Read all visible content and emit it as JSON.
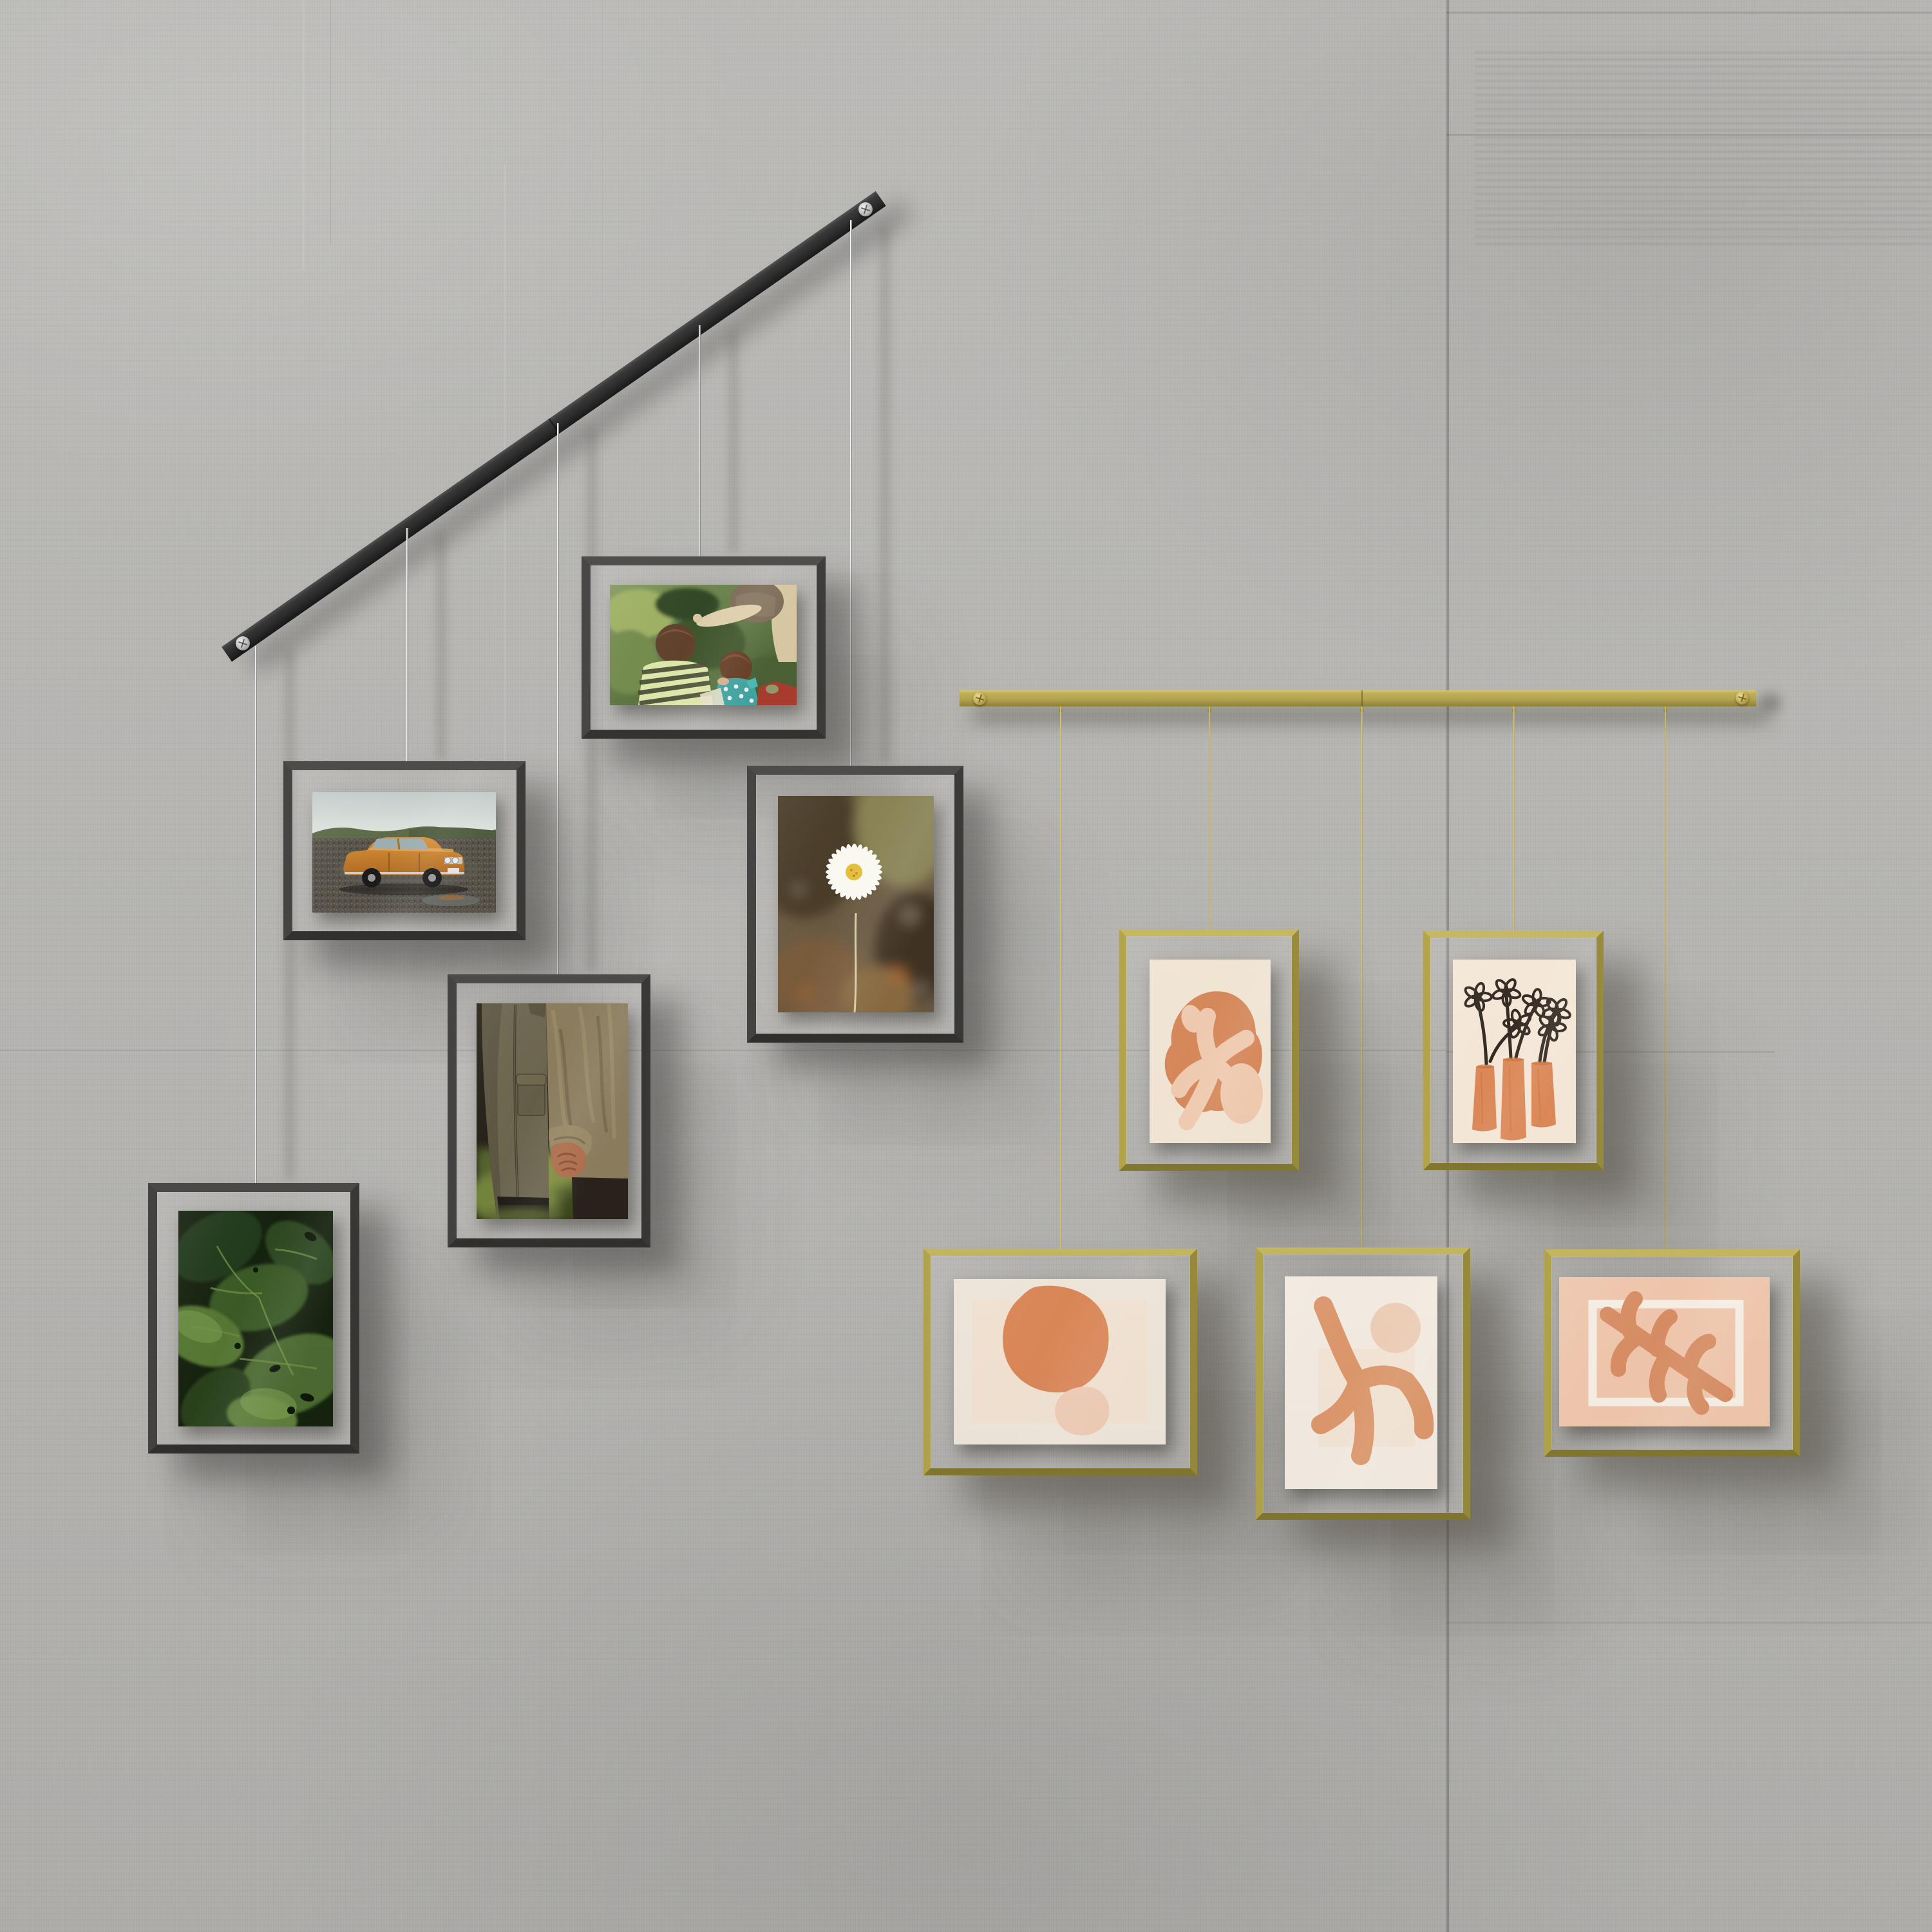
{
  "scene": {
    "title": "Two wire-hung gallery picture displays on a concrete panel wall",
    "wall": {
      "material": "poured concrete panels with seams"
    },
    "left_display": {
      "name": "black diagonal rail photo display",
      "rail_label": "black metal rail with two mounting screws",
      "frames": [
        {
          "id": "kids-photo",
          "label": "photo: two children and an adult in a green garden",
          "orientation": "landscape"
        },
        {
          "id": "car-photo",
          "label": "photo: orange vintage sedan parked on gravel",
          "orientation": "landscape"
        },
        {
          "id": "daisy-photo",
          "label": "photo: single white daisy on blurred brown field",
          "orientation": "portrait"
        },
        {
          "id": "couple-photo",
          "label": "photo: couple in jackets holding hands",
          "orientation": "portrait"
        },
        {
          "id": "leaves-photo",
          "label": "photo: dark green leaves close-up",
          "orientation": "portrait"
        }
      ]
    },
    "right_display": {
      "name": "brass horizontal rail art display",
      "rail_label": "brass metal rail with two mounting screws",
      "frames": [
        {
          "id": "coral-cutout-art",
          "label": "art print: terracotta blob with pale coral cutouts on cream",
          "orientation": "portrait"
        },
        {
          "id": "vases-art",
          "label": "art print: three terracotta vases with black sketched flowers",
          "orientation": "portrait"
        },
        {
          "id": "pebbles-art",
          "label": "art print: large terracotta pebble with small blush pebble",
          "orientation": "landscape"
        },
        {
          "id": "coral-branch-art",
          "label": "art print: terracotta coral branch with blush circle",
          "orientation": "portrait"
        },
        {
          "id": "leaf-print-art",
          "label": "art print: terracotta leaf over white outlined rectangle on peach",
          "orientation": "landscape"
        }
      ]
    }
  },
  "colors": {
    "wall": "#b9b8b5",
    "black_rail": "#262626",
    "dark_frame": "#403f3d",
    "silver_wire": "#dcdcdc",
    "brass": "#b3a44e",
    "brass_light": "#d8c96f",
    "brass_dark": "#8c8034",
    "gold_wire": "#d9c76d",
    "cream": "#f5e8d6",
    "terracotta": "#dc8a5a",
    "blush": "#f3cdb2",
    "peach": "#f5cbb0",
    "ink": "#362c24"
  }
}
